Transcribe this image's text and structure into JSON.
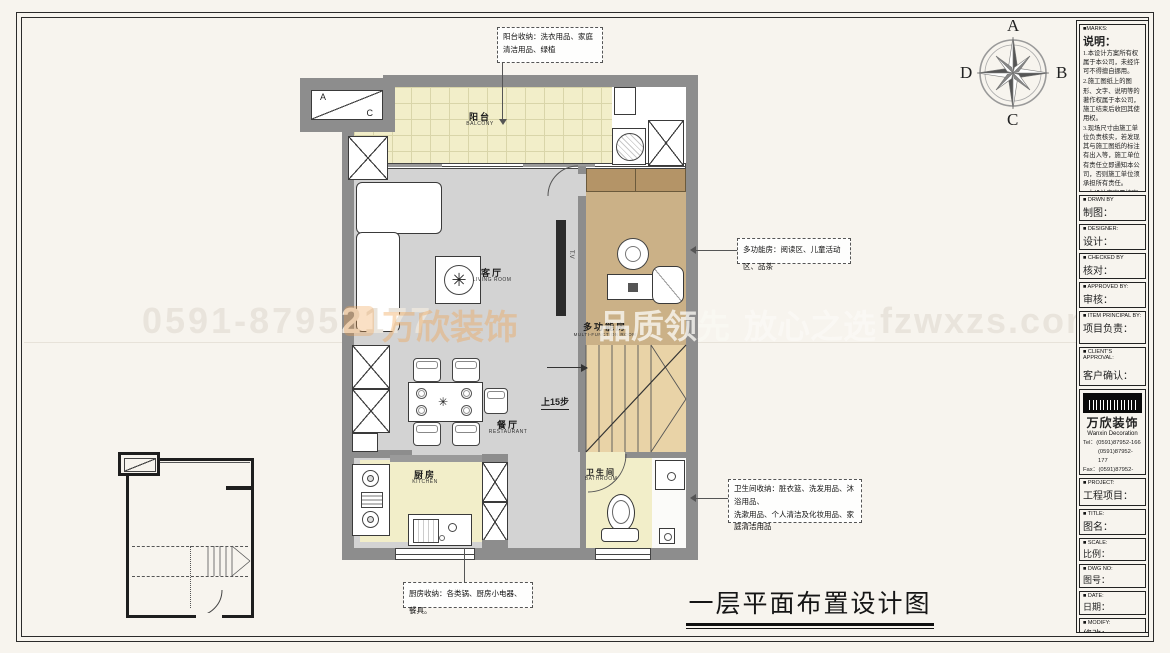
{
  "page": {
    "title": "一层平面布置设计图"
  },
  "compass": {
    "n": "A",
    "e": "B",
    "s": "C",
    "w": "D"
  },
  "watermark": {
    "phone": "0591-87952177",
    "brand": "万欣装饰",
    "slogan_1": "品质领先",
    "slogan_2": "放心之选",
    "site": "fzwxzs.com"
  },
  "rooms": {
    "balcony": {
      "cn": "阳台",
      "en": "BALCONY"
    },
    "living": {
      "cn": "客厅",
      "en": "LIVING ROOM"
    },
    "multi": {
      "cn": "多功能房",
      "en": "MULTI-FUNCTION ROOM"
    },
    "dining": {
      "cn": "餐厅",
      "en": "RESTAURANT"
    },
    "kitchen": {
      "cn": "厨房",
      "en": "KITCHEN"
    },
    "bath": {
      "cn": "卫生间",
      "en": "BATHROOM"
    }
  },
  "plan": {
    "stairs_note": "上15步",
    "tv": "T.V",
    "ac_a": "A",
    "ac_c": "C"
  },
  "annotations": {
    "balcony": "阳台收纳：洗衣用品、家庭清洁用品、绿植",
    "multi": "多功能房：阅读区、儿童活动区、品茶",
    "bath_line1": "卫生间收纳：脏衣篮、洗发用品、沐浴用品、",
    "bath_line2": "洗漱用品、个人清洁及化妆用品、家庭清洁用品",
    "kitchen": "厨房收纳：各类锅、厨房小电器、餐具。"
  },
  "titleblock": {
    "marks_en": "■MARKS:",
    "marks_cn": "说明：",
    "notes": [
      "1.本设计方案所有权属于本公司，未经许可不得擅自挪用。",
      "2.施工图纸上的图形、文字、说明等的著作权属于本公司，施工结束后收回其使用权。",
      "3.现场尺寸由施工单位负责核实，若发现其与施工图纸的标注有出入等，施工单位有责任立即通知本公司，否则施工单位须承担所有责任。",
      "4.本设计方案是按客户要求设计，经客户签字确认为同意认可，不得随意更改。"
    ],
    "fields": [
      {
        "en": "■ DRWN BY",
        "cn": "制图："
      },
      {
        "en": "■ DESIGNER:",
        "cn": "设计："
      },
      {
        "en": "■ CHECKED BY",
        "cn": "核对："
      },
      {
        "en": "■ APPROVED BY:",
        "cn": "审核："
      },
      {
        "en": "■ ITEM PRINCIPAL BY:",
        "cn": "项目负责："
      },
      {
        "en": "■ CLIENT'S APPROVAL:",
        "cn": "客户确认："
      }
    ],
    "logo": {
      "cn": "万欣装饰",
      "en": "Wanxin Decoration"
    },
    "contacts": [
      "Tel：(0591)87952-166",
      "(0591)87952-177",
      "Fax：(0591)87952-199",
      "Web：WWW.fzwxzs.com"
    ],
    "fields2": [
      {
        "en": "■ PROJECT:",
        "cn": "工程项目："
      },
      {
        "en": "■ TITLE:",
        "cn": "图名："
      },
      {
        "en": "■ SCALE:",
        "cn": "比例："
      },
      {
        "en": "■ DWG NO:",
        "cn": "图号："
      },
      {
        "en": "■ DATE:",
        "cn": "日期："
      },
      {
        "en": "■ MODIFY:",
        "cn": "修改："
      }
    ]
  }
}
